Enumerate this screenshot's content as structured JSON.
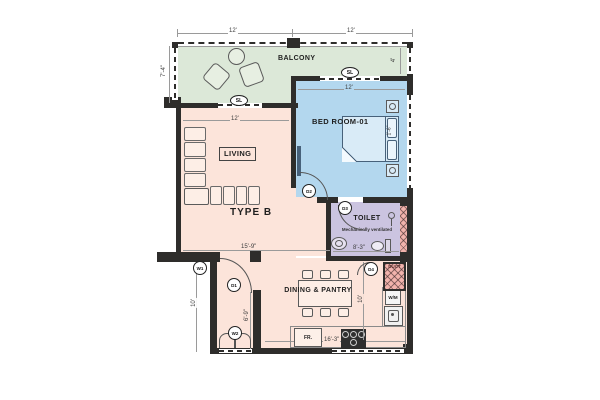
{
  "floorplan": {
    "unit_type": "TYPE B",
    "rooms": {
      "balcony": {
        "label": "BALCONY"
      },
      "bedroom": {
        "label": "BED ROOM-01"
      },
      "living": {
        "label": "LIVING"
      },
      "toilet": {
        "label": "TOILET",
        "note": "Mechanically ventilated"
      },
      "dining": {
        "label": "DINING & PANTRY"
      }
    },
    "appliances": {
      "fridge": "FR.",
      "washing_machine": "W/M",
      "duct": "DUCT"
    },
    "markers": {
      "sl": "SL",
      "d1": "D1",
      "d2": "D2",
      "d3": "D3",
      "d4": "D4",
      "w1": "W1",
      "w2": "W2"
    },
    "dimensions": {
      "top_left": "12'",
      "top_right": "12'",
      "balcony_depth_left": "7'-4\"",
      "balcony_depth_right": "4'",
      "bedroom_width": "12'",
      "living_width": "12'",
      "living_length": "15'-9\"",
      "toilet_width": "8'-3\"",
      "kitchen_width": "16'-3\"",
      "corridor_height": "10'",
      "dining_height": "10'",
      "inner_wall_height": "6'-9\"",
      "bed_head_width": "1'-6\""
    },
    "colors": {
      "balcony": "#dce8d8",
      "bedroom": "#b3d7ee",
      "living": "#fce4da",
      "toilet": "#cbc4e0",
      "duct": "#f2b3ac",
      "wall": "#2e2d2b"
    }
  }
}
